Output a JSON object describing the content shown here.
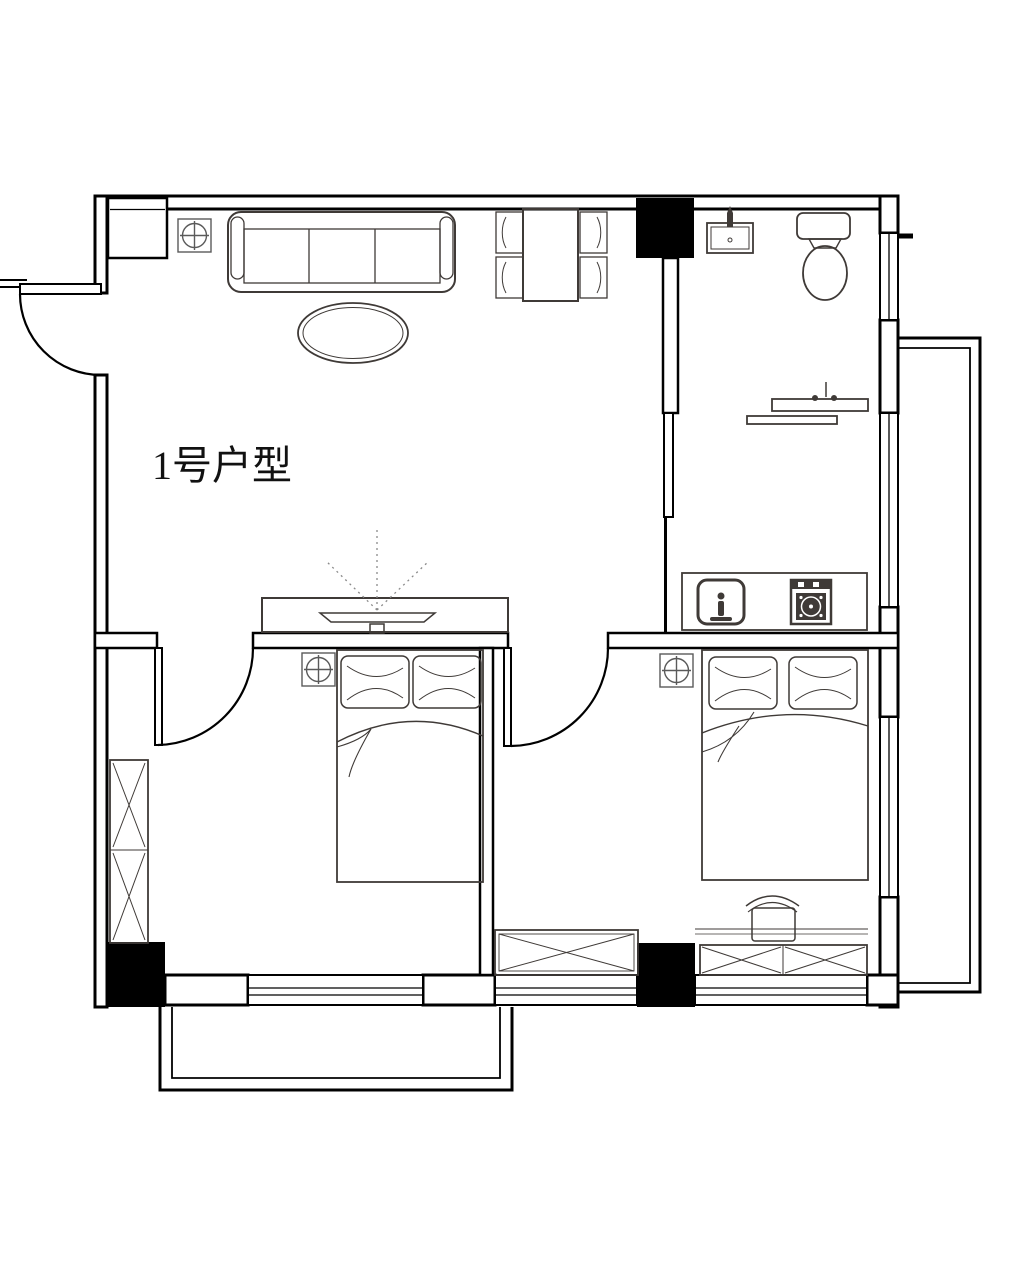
{
  "plan": {
    "unit_label": "1号户型",
    "colors": {
      "background": "#ffffff",
      "wall": "#000000",
      "furniture": "#3f3a37",
      "marker": "#5a5a5a",
      "dotted": "#8a8a8a",
      "label": "#111111"
    },
    "elements": {
      "columns": [
        "top-structural-column",
        "bottom-left-structural-column",
        "bottom-center-structural-column"
      ],
      "doors": [
        "entry-swing-door",
        "left-bedroom-swing-door",
        "right-bedroom-swing-door",
        "bathroom-sliding-door"
      ],
      "windows": [
        "right-wall-window-upper",
        "right-wall-window-middle",
        "right-wall-window-lower",
        "bottom-window-left-bedroom",
        "bottom-window-center",
        "bottom-window-right-bedroom"
      ],
      "balconies": [
        "right-balcony",
        "bottom-balcony"
      ],
      "markers": [
        "column-marker-entry",
        "column-marker-left-bedroom",
        "column-marker-right-bedroom"
      ],
      "furniture": [
        "sofa",
        "coffee-table",
        "tv-cabinet",
        "tv",
        "dining-table",
        "dining-chairs",
        "bathroom-sink",
        "toilet",
        "vanity-shelf",
        "kitchen-counter",
        "kitchen-sink",
        "cooktop",
        "left-double-bed",
        "right-double-bed",
        "pillows",
        "wardrobe",
        "desk",
        "desk-chair",
        "low-cabinet-left-bedroom",
        "low-cabinet-right-bedroom"
      ]
    }
  }
}
